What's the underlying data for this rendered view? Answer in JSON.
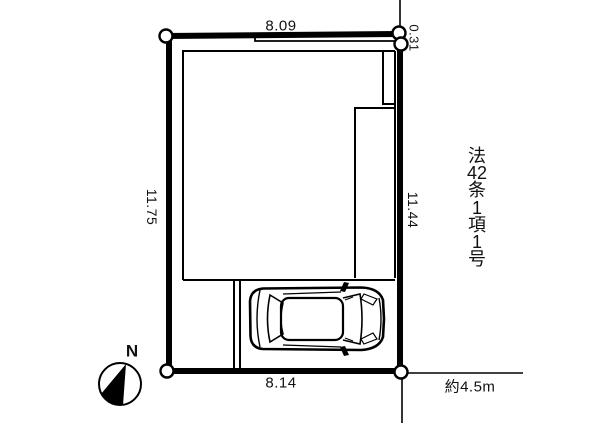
{
  "colors": {
    "line": "#000000",
    "background": "#ffffff"
  },
  "plot": {
    "dimensions": {
      "top": "8.09",
      "top_right": "0.31",
      "left": "11.75",
      "right": "11.44",
      "bottom": "8.14"
    },
    "road_width_label": "約4.5m",
    "regulation_text": "法42条1項1号",
    "regulation_lines": [
      "法",
      "42",
      "条",
      "1",
      "項",
      "1",
      "号"
    ]
  },
  "compass": {
    "label": "N"
  }
}
